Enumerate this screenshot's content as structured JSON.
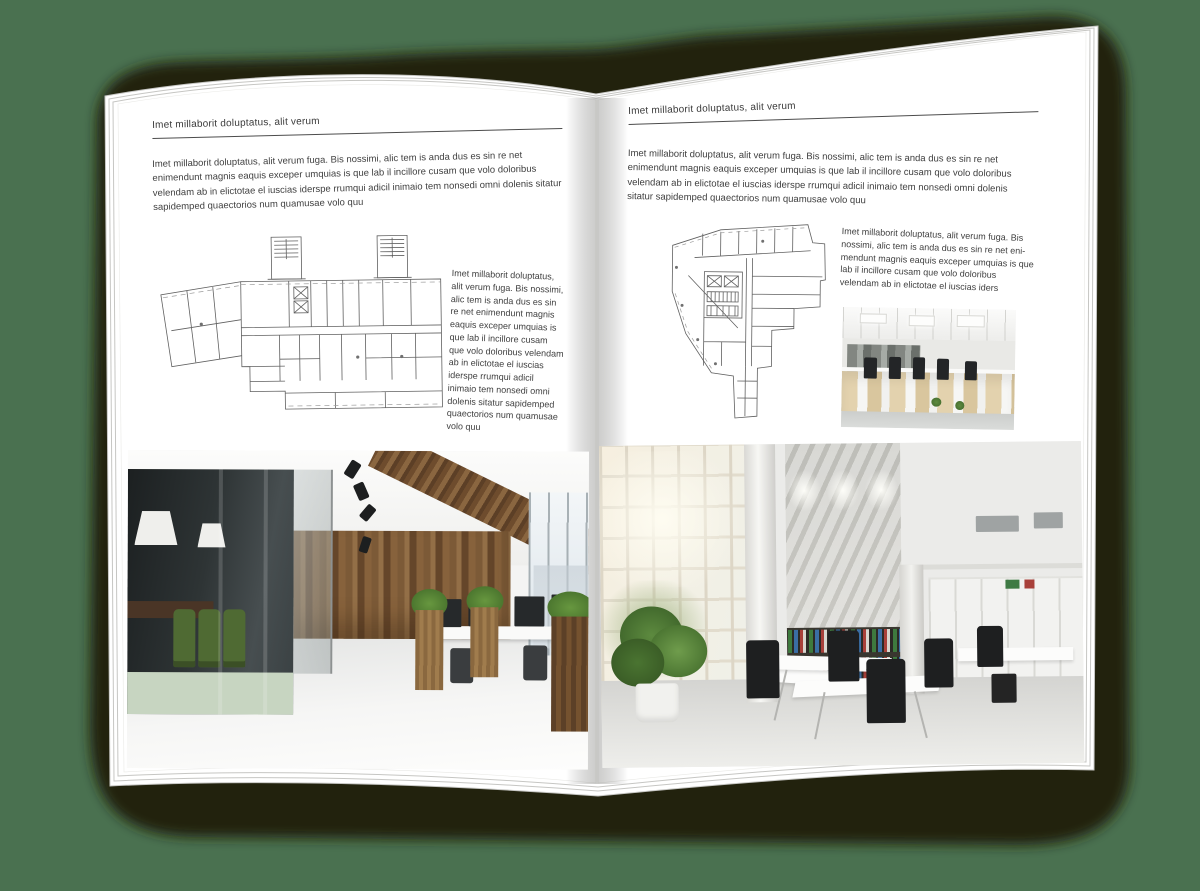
{
  "canvas": {
    "background_color": "#4a7150",
    "shadow_color": "#20240f",
    "page_color": "#ffffff",
    "text_color": "#3e3e3e",
    "rule_color": "#4c4c4c"
  },
  "left_page": {
    "header": "Imet millaborit doluptatus, alit verum",
    "intro": "Imet millaborit doluptatus, alit verum fuga. Bis nossimi, alic tem is anda dus es sin re net enimendunt magnis eaquis exceper umquias is que lab il incillore cusam que volo doloribus velendam ab in elictotae el iuscias iderspe rrumqui adicil inimaio tem nonsedi omni dolenis sitatur sapidemped quaectorios num quamusae volo quu",
    "side_text": "Imet millaborit doluptatus, alit verum fuga. Bis nossimi, alic tem is anda dus es sin re net enimendunt magnis eaquis exceper umquias is que lab il incillore cusam que volo doloribus velendam ab in elictotae el iuscias iderspe rrumqui adicil inimaio tem nonsedi omni dolenis sitatur sapidemped quaectorios num quamusae volo quu",
    "floor_plan": "wide-building-architectural-floor-plan",
    "photo": "wood-and-glass-office-interior-photo"
  },
  "right_page": {
    "header": "Imet millaborit doluptatus, alit verum",
    "intro": "Imet millaborit doluptatus, alit verum fuga. Bis nossimi, alic tem is anda dus es sin re net enimendunt magnis eaquis exceper umquias is que lab il incillore cusam que volo doloribus velendam ab in elictotae el iuscias iderspe rrumqui adicil inimaio tem nonsedi omni dolenis sitatur sapidemped quaectorios num quamusae volo quu",
    "side_text": "Imet millaborit doluptatus, alit verum fuga. Bis nossimi, alic tem is anda dus es sin re net eni-mendunt magnis eaquis exceper umquias is que lab il incillore cusam que volo doloribus velendam ab in elictotae el iuscias iders",
    "floor_plan": "irregular-building-architectural-floor-plan",
    "photo_small": "open-plan-office-desks-photo",
    "photo_large": "bright-loft-office-interior-photo"
  }
}
